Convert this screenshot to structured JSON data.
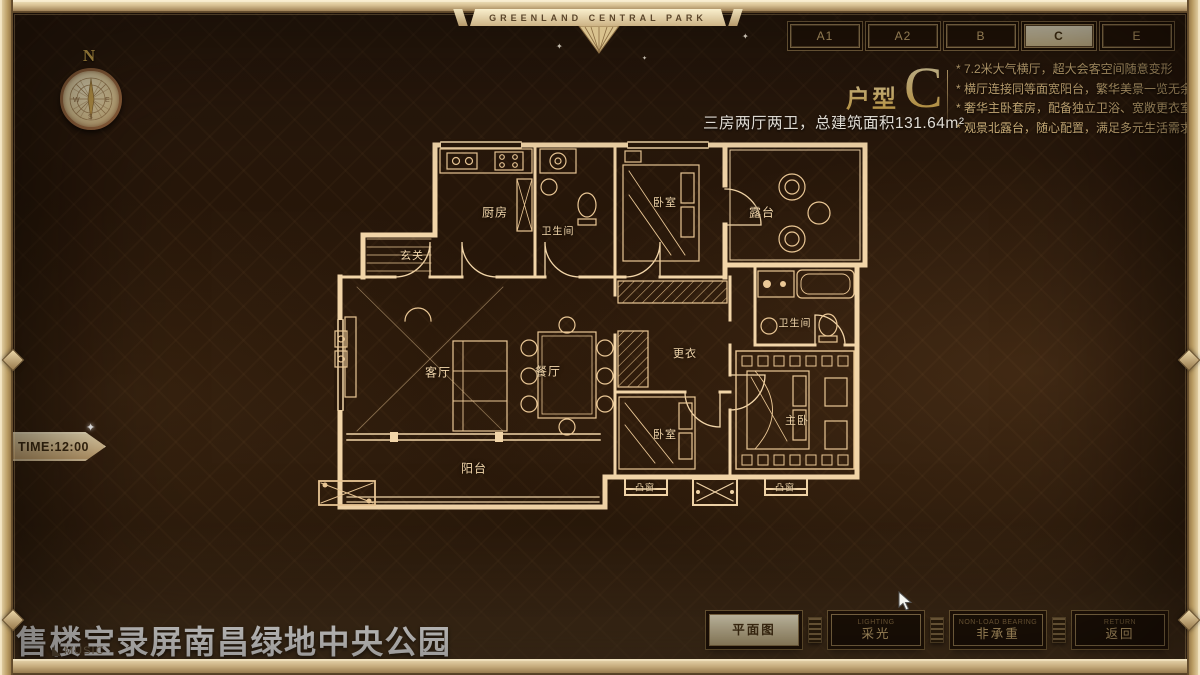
{
  "brand_banner": {
    "text": "GREENLAND CENTRAL PARK"
  },
  "unit_tabs": [
    {
      "label": "A1",
      "active": false
    },
    {
      "label": "A2",
      "active": false
    },
    {
      "label": "B",
      "active": false
    },
    {
      "label": "C",
      "active": true
    },
    {
      "label": "E",
      "active": false
    }
  ],
  "compass": {
    "north": "N",
    "west": "W",
    "east": "E",
    "south": "S"
  },
  "unit_info": {
    "type_label": "户型",
    "type_letter": "C",
    "specs": "三房两厅两卫，总建筑面积131.64m²",
    "features": [
      "* 7.2米大气横厅，超大会客空间随意变形",
      "* 横厅连接同等面宽阳台，繁华美景一览无余",
      "* 奢华主卧套房，配备独立卫浴、宽敞更衣室",
      "* 观景北露台，随心配置，满足多元生活需求"
    ]
  },
  "floor_plan": {
    "rooms": [
      {
        "label": "玄关",
        "x": 117,
        "y": 120,
        "size": 11
      },
      {
        "label": "厨房",
        "x": 200,
        "y": 77,
        "size": 12
      },
      {
        "label": "卫生间",
        "x": 263,
        "y": 95,
        "size": 10
      },
      {
        "label": "卧室",
        "x": 370,
        "y": 67,
        "size": 11
      },
      {
        "label": "露台",
        "x": 467,
        "y": 77,
        "size": 12
      },
      {
        "label": "客厅",
        "x": 143,
        "y": 237,
        "size": 12
      },
      {
        "label": "餐厅",
        "x": 253,
        "y": 236,
        "size": 12
      },
      {
        "label": "更衣",
        "x": 390,
        "y": 218,
        "size": 11
      },
      {
        "label": "卫生间",
        "x": 500,
        "y": 187,
        "size": 10
      },
      {
        "label": "主卧",
        "x": 502,
        "y": 285,
        "size": 11
      },
      {
        "label": "卧室",
        "x": 370,
        "y": 299,
        "size": 11
      },
      {
        "label": "阳台",
        "x": 179,
        "y": 333,
        "size": 12
      },
      {
        "label": "凸窗",
        "x": 350,
        "y": 352,
        "size": 9
      },
      {
        "label": "凸窗",
        "x": 490,
        "y": 352,
        "size": 9
      }
    ]
  },
  "time_badge": {
    "text": "TIME:12:00"
  },
  "watermark": {
    "text": "售楼宝录屏南昌绿地中央公园"
  },
  "music": {
    "label": "MUSIC"
  },
  "footer_buttons": [
    {
      "label": "平面图",
      "sublabel": "",
      "active": true
    },
    {
      "label": "采光",
      "sublabel": "LIGHTING",
      "active": false
    },
    {
      "label": "非承重",
      "sublabel": "NON-LOAD BEARING",
      "active": false
    },
    {
      "label": "返回",
      "sublabel": "RETURN",
      "active": false
    }
  ],
  "colors": {
    "frame_gold": "#b89a6c",
    "accent_gold": "#d8b878",
    "active_cream": "#f3e9c8",
    "plan_line": "#f2d5a8",
    "text_white": "#f2ece2"
  }
}
